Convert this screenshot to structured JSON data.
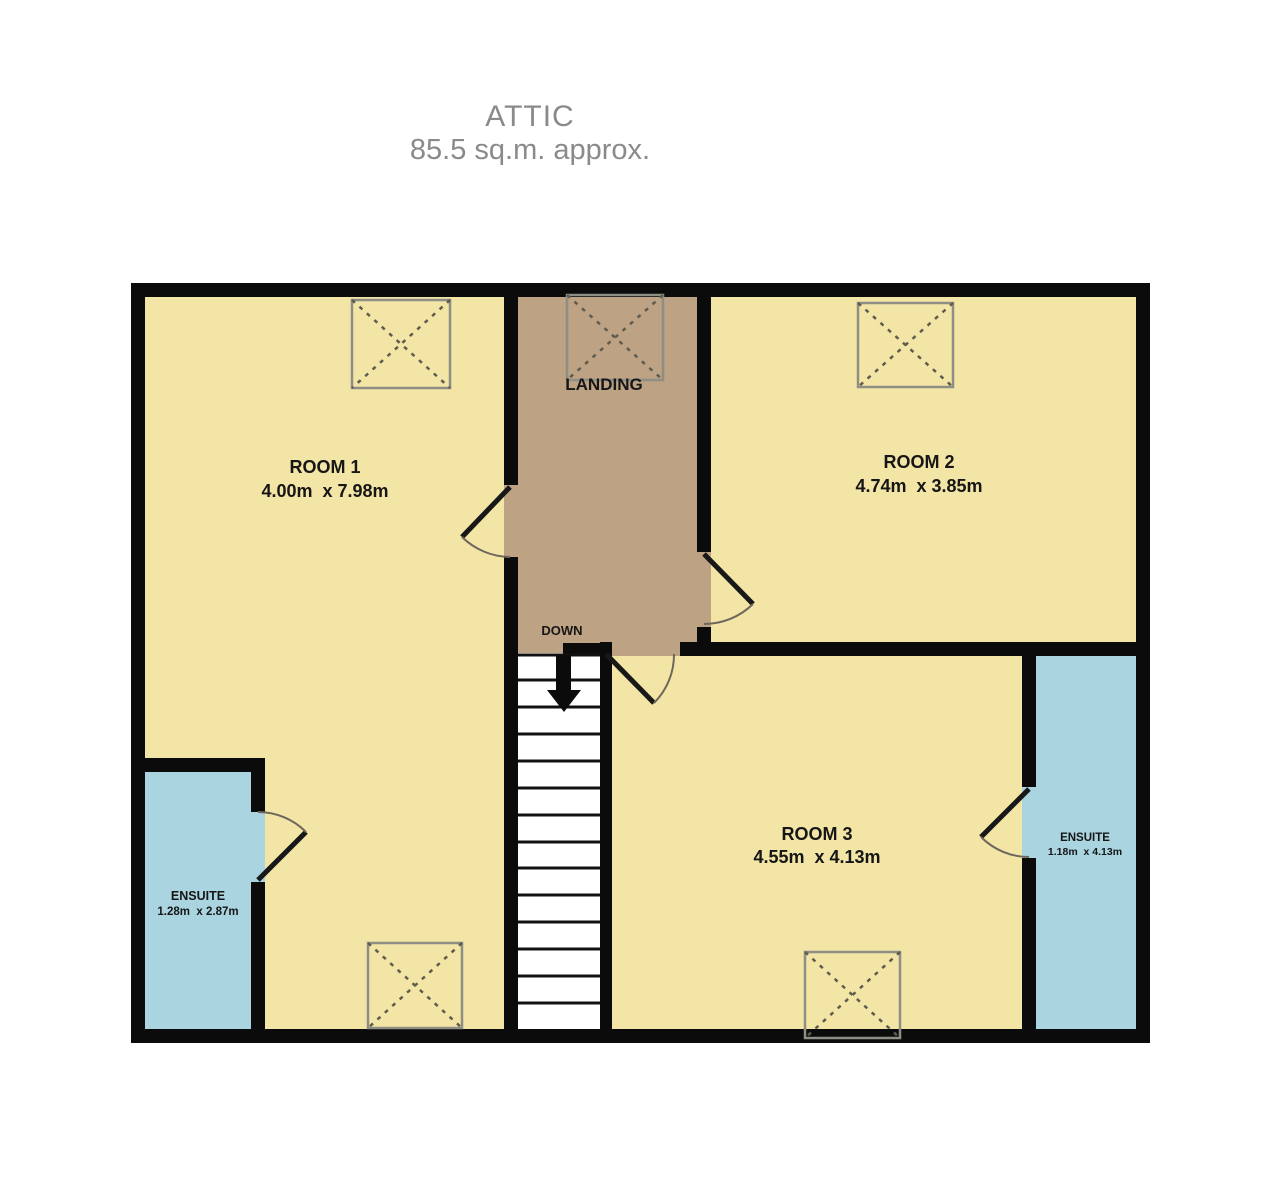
{
  "header": {
    "title": "ATTIC",
    "subtitle": "85.5 sq.m. approx."
  },
  "plan": {
    "landing": {
      "label": "LANDING"
    },
    "stairs": {
      "down_label": "DOWN"
    },
    "room1": {
      "label": "ROOM 1",
      "dims": "4.00m  x 7.98m"
    },
    "room2": {
      "label": "ROOM 2",
      "dims": "4.74m  x 3.85m"
    },
    "room3": {
      "label": "ROOM 3",
      "dims": "4.55m  x 4.13m"
    },
    "ensuite1": {
      "label": "ENSUITE",
      "dims": "1.28m  x 2.87m"
    },
    "ensuite2": {
      "label": "ENSUITE",
      "dims": "1.18m  x 4.13m"
    },
    "colors": {
      "room_fill": "#F3E5A6",
      "landing_fill": "#BEA284",
      "landing_skylight_fill": "#C9B294",
      "ensuite_fill": "#A9D4E0",
      "stairs_fill": "#FFFFFF",
      "wall": "#0B0B0B",
      "title_text": "#8A8A8A"
    }
  }
}
